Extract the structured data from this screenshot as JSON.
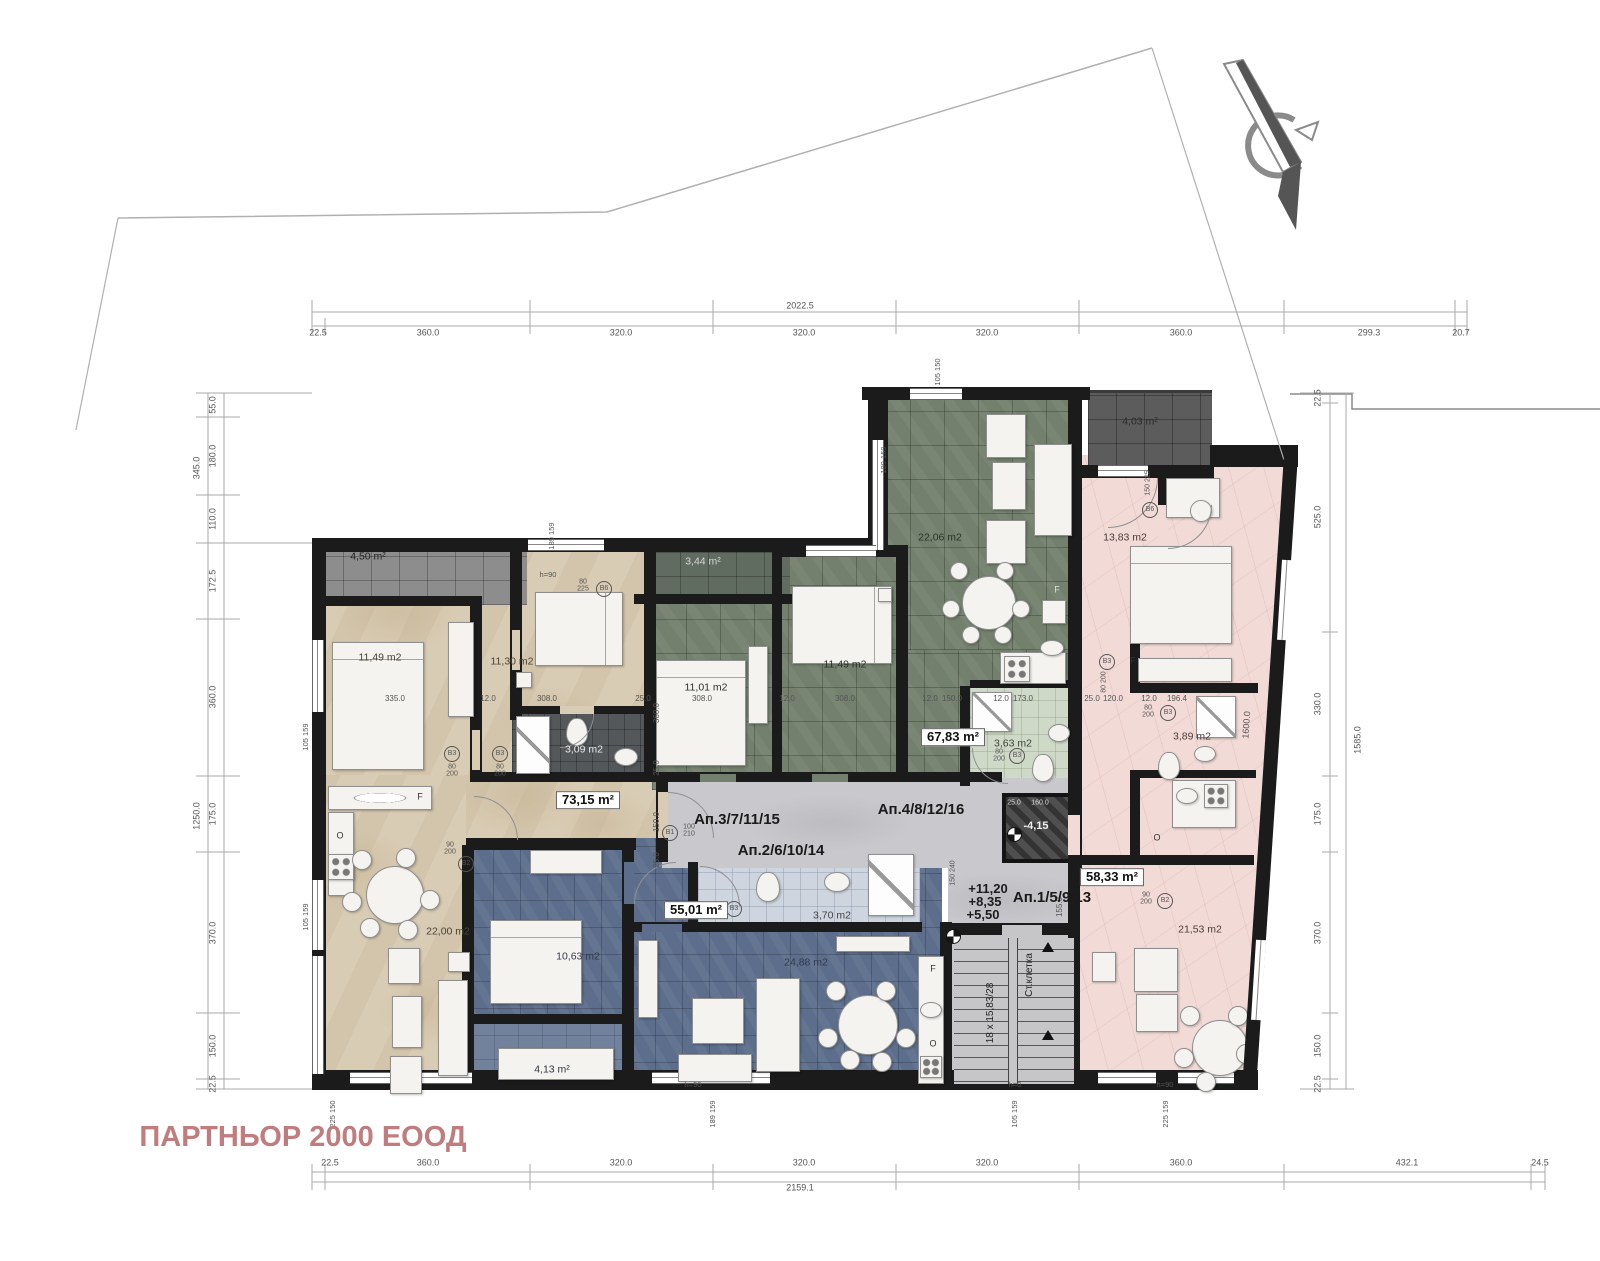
{
  "document": {
    "type": "architectural-floor-plan",
    "company": "ПАРТНЬОР 2000 ЕООД",
    "company_color": "#c17c7e"
  },
  "apartments": [
    {
      "label": "Ап.1/5/9/13",
      "area": "58,33 m²",
      "color": "#f2dbd7",
      "rooms": {
        "bedroom": "13,83 m2",
        "bathroom": "3,89 m2",
        "living_kitchen": "21,53 m2",
        "terrace": "4,03 m²"
      }
    },
    {
      "label": "Ап.2/6/10/14",
      "area": "55,01 m²",
      "color": "#5c6e8c",
      "rooms": {
        "bedroom": "10,63 m2",
        "bathroom": "3,70 m2",
        "living_kitchen": "24,88 m2",
        "terrace": "4,13 m²"
      }
    },
    {
      "label": "Ап.3/7/11/15",
      "area": "73,15 m²",
      "color": "#d9ccb4",
      "rooms": {
        "bedroom_1": "11,49 m2",
        "bedroom_2": "11,30 m2",
        "bathroom": "3,09 m2",
        "living_kitchen": "22,00 m2",
        "terrace": "4,50 m²"
      }
    },
    {
      "label": "Ап.4/8/12/16",
      "area": "67,83 m²",
      "color": "#72806d",
      "rooms": {
        "bedroom_1": "11,01 m2",
        "bedroom_2": "11,49 m2",
        "bathroom": "3,63 m2",
        "living_kitchen": "22,06 m2",
        "terrace": "3,44 m²"
      }
    }
  ],
  "stairwell": {
    "label": "Ст.клетка",
    "steps": "18 x 15,83/28",
    "levels": [
      "+11,20",
      "+8,35",
      "+5,50",
      "+2,65"
    ],
    "shaft_level": "-4,15"
  },
  "site_dimensions": {
    "top_chain": [
      "22.5",
      "360.0",
      "320.0",
      "320.0",
      "320.0",
      "360.0",
      "299.3",
      "20.7"
    ],
    "top_total": "2022.5",
    "bottom_chain": [
      "22.5",
      "360.0",
      "320.0",
      "320.0",
      "320.0",
      "360.0",
      "432.1",
      "24.5"
    ],
    "bottom_total": "2159.1",
    "left_upper_chain": [
      "55.0",
      "180.0",
      "110.0"
    ],
    "left_upper_total": "345.0",
    "left_chain": [
      "172.5",
      "360.0",
      "175.0",
      "370.0",
      "150.0",
      "22.5"
    ],
    "left_total": "1250.0",
    "right_chain": [
      "22.5",
      "525.0",
      "330.0",
      "175.0",
      "370.0",
      "150.0",
      "22.5"
    ],
    "right_total": "1585.0",
    "diagonal": "1600.0"
  },
  "plan": {
    "labels": [
      {
        "t": "22.5",
        "x": 318,
        "y": 333
      },
      {
        "t": "360.0",
        "x": 428,
        "y": 333
      },
      {
        "t": "320.0",
        "x": 621,
        "y": 333
      },
      {
        "t": "320.0",
        "x": 804,
        "y": 333
      },
      {
        "t": "320.0",
        "x": 987,
        "y": 333
      },
      {
        "t": "360.0",
        "x": 1181,
        "y": 333
      },
      {
        "t": "299.3",
        "x": 1369,
        "y": 333
      },
      {
        "t": "20.7",
        "x": 1461,
        "y": 333
      },
      {
        "t": "2022.5",
        "x": 800,
        "y": 306
      },
      {
        "t": "22.5",
        "x": 330,
        "y": 1163
      },
      {
        "t": "360.0",
        "x": 428,
        "y": 1163
      },
      {
        "t": "320.0",
        "x": 621,
        "y": 1163
      },
      {
        "t": "320.0",
        "x": 804,
        "y": 1163
      },
      {
        "t": "320.0",
        "x": 987,
        "y": 1163
      },
      {
        "t": "360.0",
        "x": 1181,
        "y": 1163
      },
      {
        "t": "432.1",
        "x": 1407,
        "y": 1163
      },
      {
        "t": "24.5",
        "x": 1540,
        "y": 1163
      },
      {
        "t": "2159.1",
        "x": 800,
        "y": 1188
      },
      {
        "t": "55.0",
        "x": 213,
        "y": 405,
        "r": -90
      },
      {
        "t": "180.0",
        "x": 213,
        "y": 456,
        "r": -90
      },
      {
        "t": "110.0",
        "x": 213,
        "y": 519,
        "r": -90
      },
      {
        "t": "345.0",
        "x": 197,
        "y": 468,
        "r": -90
      },
      {
        "t": "172.5",
        "x": 213,
        "y": 581,
        "r": -90
      },
      {
        "t": "360.0",
        "x": 213,
        "y": 697,
        "r": -90
      },
      {
        "t": "175.0",
        "x": 213,
        "y": 814,
        "r": -90
      },
      {
        "t": "370.0",
        "x": 213,
        "y": 933,
        "r": -90
      },
      {
        "t": "150.0",
        "x": 213,
        "y": 1046,
        "r": -90
      },
      {
        "t": "22.5",
        "x": 213,
        "y": 1084,
        "r": -90
      },
      {
        "t": "1250.0",
        "x": 197,
        "y": 816,
        "r": -90
      },
      {
        "t": "22.5",
        "x": 1318,
        "y": 398,
        "r": -90
      },
      {
        "t": "525.0",
        "x": 1318,
        "y": 517,
        "r": -90
      },
      {
        "t": "330.0",
        "x": 1318,
        "y": 704,
        "r": -90
      },
      {
        "t": "175.0",
        "x": 1318,
        "y": 814,
        "r": -90
      },
      {
        "t": "370.0",
        "x": 1318,
        "y": 933,
        "r": -90
      },
      {
        "t": "150.0",
        "x": 1318,
        "y": 1046,
        "r": -90
      },
      {
        "t": "22.5",
        "x": 1318,
        "y": 1084,
        "r": -90
      },
      {
        "t": "1585.0",
        "x": 1358,
        "y": 740,
        "r": -90
      },
      {
        "t": "1600.0",
        "x": 1247,
        "y": 725,
        "r": -86
      },
      {
        "t": "335.0",
        "x": 395,
        "y": 699,
        "s": 8
      },
      {
        "t": "12.0",
        "x": 488,
        "y": 699,
        "s": 8
      },
      {
        "t": "308.0",
        "x": 547,
        "y": 699,
        "s": 8
      },
      {
        "t": "25.0",
        "x": 643,
        "y": 699,
        "s": 8
      },
      {
        "t": "308.0",
        "x": 702,
        "y": 699,
        "s": 8
      },
      {
        "t": "12.0",
        "x": 787,
        "y": 699,
        "s": 8
      },
      {
        "t": "308.0",
        "x": 845,
        "y": 699,
        "s": 8
      },
      {
        "t": "12.0",
        "x": 930,
        "y": 699,
        "s": 8
      },
      {
        "t": "150.0",
        "x": 952,
        "y": 699,
        "s": 8
      },
      {
        "t": "12.0",
        "x": 1001,
        "y": 699,
        "s": 8
      },
      {
        "t": "173.0",
        "x": 1023,
        "y": 699,
        "s": 8
      },
      {
        "t": "25.0",
        "x": 1092,
        "y": 699,
        "s": 8
      },
      {
        "t": "120.0",
        "x": 1113,
        "y": 699,
        "s": 8
      },
      {
        "t": "12.0",
        "x": 1149,
        "y": 699,
        "s": 8
      },
      {
        "t": "196.4",
        "x": 1177,
        "y": 699,
        "s": 8
      },
      {
        "t": "360.0",
        "x": 657,
        "y": 713,
        "r": -90,
        "s": 8
      },
      {
        "t": "25.0",
        "x": 657,
        "y": 768,
        "r": -90,
        "s": 8
      },
      {
        "t": "150.0",
        "x": 657,
        "y": 822,
        "r": -90,
        "s": 8
      },
      {
        "t": "25.0",
        "x": 657,
        "y": 860,
        "r": -90,
        "s": 8
      },
      {
        "t": "155.0",
        "x": 1060,
        "y": 907,
        "r": -90,
        "s": 8
      },
      {
        "t": "105  150",
        "x": 938,
        "y": 372,
        "r": -90,
        "s": 7.5
      },
      {
        "t": "189  159",
        "x": 884,
        "y": 460,
        "r": -90,
        "s": 7.5
      },
      {
        "t": "189  159",
        "x": 552,
        "y": 536,
        "r": -90,
        "s": 7.5
      },
      {
        "t": "225  150",
        "x": 333,
        "y": 1114,
        "r": -90,
        "s": 7.5
      },
      {
        "t": "189  159",
        "x": 713,
        "y": 1114,
        "r": -90,
        "s": 7.5
      },
      {
        "t": "105  159",
        "x": 1015,
        "y": 1114,
        "r": -90,
        "s": 7.5
      },
      {
        "t": "225  159",
        "x": 1166,
        "y": 1114,
        "r": -90,
        "s": 7.5
      },
      {
        "t": "105  159",
        "x": 306,
        "y": 737,
        "r": -90,
        "s": 7.5
      },
      {
        "t": "105  159",
        "x": 306,
        "y": 917,
        "r": -90,
        "s": 7.5
      },
      {
        "t": "80\n225",
        "x": 583,
        "y": 586,
        "s": 7
      },
      {
        "t": "B6",
        "x": 604,
        "y": 589,
        "circ": true
      },
      {
        "t": "150  225",
        "x": 1148,
        "y": 483,
        "r": -90,
        "s": 7
      },
      {
        "t": "B6",
        "x": 1150,
        "y": 510,
        "circ": true
      },
      {
        "t": "80\n200",
        "x": 452,
        "y": 771,
        "s": 7
      },
      {
        "t": "B3",
        "x": 452,
        "y": 754,
        "circ": true
      },
      {
        "t": "80\n200",
        "x": 500,
        "y": 771,
        "s": 7
      },
      {
        "t": "B3",
        "x": 500,
        "y": 754,
        "circ": true
      },
      {
        "t": "90\n200",
        "x": 450,
        "y": 849,
        "s": 7
      },
      {
        "t": "B2",
        "x": 466,
        "y": 864,
        "circ": true
      },
      {
        "t": "100\n210",
        "x": 689,
        "y": 831,
        "s": 7
      },
      {
        "t": "B1",
        "x": 670,
        "y": 833,
        "circ": true
      },
      {
        "t": "80\n200",
        "x": 712,
        "y": 910,
        "s": 7
      },
      {
        "t": "B3",
        "x": 734,
        "y": 909,
        "circ": true
      },
      {
        "t": "80\n200",
        "x": 999,
        "y": 756,
        "s": 7
      },
      {
        "t": "B3",
        "x": 1017,
        "y": 756,
        "circ": true
      },
      {
        "t": "80  200",
        "x": 1104,
        "y": 682,
        "r": -90,
        "s": 7
      },
      {
        "t": "B3",
        "x": 1107,
        "y": 662,
        "circ": true
      },
      {
        "t": "80\n200",
        "x": 1148,
        "y": 712,
        "s": 7
      },
      {
        "t": "B3",
        "x": 1168,
        "y": 713,
        "circ": true
      },
      {
        "t": "90\n200",
        "x": 1146,
        "y": 899,
        "s": 7
      },
      {
        "t": "B2",
        "x": 1165,
        "y": 901,
        "circ": true
      },
      {
        "t": "150  240",
        "x": 953,
        "y": 873,
        "r": -90,
        "s": 7
      },
      {
        "t": "+11,20",
        "x": 988,
        "y": 889,
        "s": 13,
        "b": true,
        "c": "#1c1c1c",
        "n": "elevation-level-4"
      },
      {
        "t": "+8,35",
        "x": 985,
        "y": 902,
        "s": 13,
        "b": true,
        "c": "#1c1c1c",
        "n": "elevation-level-3"
      },
      {
        "t": "+5,50",
        "x": 983,
        "y": 915,
        "s": 13,
        "b": true,
        "c": "#1c1c1c",
        "n": "elevation-level-2"
      },
      {
        "t": "+2,65",
        "x": 982,
        "y": 928,
        "s": 13,
        "b": true,
        "c": "#1c1c1c",
        "n": "elevation-level-1"
      },
      {
        "t": "-4,15",
        "x": 1036,
        "y": 827,
        "s": 11,
        "b": true,
        "c": "#f0f0f0",
        "n": "shaft-elevation"
      },
      {
        "t": "25.0",
        "x": 1014,
        "y": 803,
        "s": 7,
        "c": "#ddd"
      },
      {
        "t": "160.0",
        "x": 1040,
        "y": 803,
        "s": 7,
        "c": "#ddd"
      },
      {
        "t": "Ап.3/7/11/15",
        "x": 737,
        "y": 820,
        "s": 15,
        "b": true,
        "c": "#1a1a1a",
        "n": "apartment-label-3"
      },
      {
        "t": "Ап.2/6/10/14",
        "x": 781,
        "y": 851,
        "s": 15,
        "b": true,
        "c": "#1a1a1a",
        "n": "apartment-label-2"
      },
      {
        "t": "Ап.4/8/12/16",
        "x": 921,
        "y": 810,
        "s": 15,
        "b": true,
        "c": "#1a1a1a",
        "n": "apartment-label-4"
      },
      {
        "t": "Ап.1/5/9/13",
        "x": 1052,
        "y": 898,
        "s": 15,
        "b": true,
        "c": "#1a1a1a",
        "n": "apartment-label-1"
      },
      {
        "t": "73,15 m²",
        "x": 588,
        "y": 800,
        "s": 13,
        "b": true,
        "chip": true,
        "n": "area-chip-apt3"
      },
      {
        "t": "55,01 m²",
        "x": 696,
        "y": 910,
        "s": 13,
        "b": true,
        "chip": true,
        "n": "area-chip-apt2"
      },
      {
        "t": "67,83 m²",
        "x": 953,
        "y": 737,
        "s": 13,
        "b": true,
        "chip": true,
        "n": "area-chip-apt4"
      },
      {
        "t": "58,33 m²",
        "x": 1112,
        "y": 877,
        "s": 13,
        "b": true,
        "chip": true,
        "n": "area-chip-apt1"
      },
      {
        "t": "4,50 m²",
        "x": 368,
        "y": 557,
        "s": 10.5,
        "c": "#222",
        "n": "room-area"
      },
      {
        "t": "11,49 m2",
        "x": 380,
        "y": 658,
        "s": 10.5,
        "c": "#4a4336",
        "n": "room-area"
      },
      {
        "t": "11,30 m2",
        "x": 512,
        "y": 662,
        "s": 10.5,
        "c": "#4a4336",
        "n": "room-area"
      },
      {
        "t": "3,09 m2",
        "x": 584,
        "y": 750,
        "s": 10.5,
        "c": "#e8e8e8",
        "n": "room-area"
      },
      {
        "t": "22,00 m2",
        "x": 448,
        "y": 932,
        "s": 10.5,
        "c": "#4a4336",
        "n": "room-area"
      },
      {
        "t": "3,44 m²",
        "x": 703,
        "y": 562,
        "s": 10.5,
        "c": "#d6d6d6",
        "n": "room-area"
      },
      {
        "t": "11,01 m2",
        "x": 706,
        "y": 688,
        "s": 10.5,
        "c": "#2c332a",
        "n": "room-area"
      },
      {
        "t": "11,49 m2",
        "x": 845,
        "y": 665,
        "s": 10.5,
        "c": "#2c332a",
        "n": "room-area"
      },
      {
        "t": "22,06 m2",
        "x": 940,
        "y": 538,
        "s": 10.5,
        "c": "#2c332a",
        "n": "room-area"
      },
      {
        "t": "3,63 m2",
        "x": 1013,
        "y": 744,
        "s": 10.5,
        "c": "#3c4438",
        "n": "room-area"
      },
      {
        "t": "4,03 m²",
        "x": 1140,
        "y": 422,
        "s": 10.5,
        "c": "#2b2b2b",
        "n": "room-area"
      },
      {
        "t": "13,83 m2",
        "x": 1125,
        "y": 538,
        "s": 10.5,
        "c": "#4c3c3a",
        "n": "room-area"
      },
      {
        "t": "3,89 m2",
        "x": 1192,
        "y": 737,
        "s": 10.5,
        "c": "#4c3c3a",
        "n": "room-area"
      },
      {
        "t": "10,63 m2",
        "x": 578,
        "y": 957,
        "s": 10.5,
        "c": "#323a49",
        "n": "room-area"
      },
      {
        "t": "24,88 m2",
        "x": 806,
        "y": 963,
        "s": 10.5,
        "c": "#323a49",
        "n": "room-area"
      },
      {
        "t": "4,13 m²",
        "x": 552,
        "y": 1070,
        "s": 10.5,
        "c": "#2e3542",
        "n": "room-area"
      },
      {
        "t": "21,53 m2",
        "x": 1200,
        "y": 930,
        "s": 10.5,
        "c": "#4c3c3a",
        "n": "room-area"
      },
      {
        "t": "3,70 m2",
        "x": 832,
        "y": 916,
        "s": 10.5,
        "c": "#444",
        "n": "room-area"
      },
      {
        "t": "F",
        "x": 420,
        "y": 797,
        "s": 9,
        "c": "#333",
        "n": "fridge-letter"
      },
      {
        "t": "O",
        "x": 340,
        "y": 836,
        "s": 9,
        "c": "#333",
        "n": "oven-letter"
      },
      {
        "t": "F",
        "x": 1057,
        "y": 590,
        "s": 9,
        "c": "#ddd",
        "n": "fridge-letter"
      },
      {
        "t": "F",
        "x": 933,
        "y": 969,
        "s": 9,
        "c": "#333",
        "n": "fridge-letter"
      },
      {
        "t": "O",
        "x": 933,
        "y": 1044,
        "s": 9,
        "c": "#333",
        "n": "oven-letter"
      },
      {
        "t": "O",
        "x": 1157,
        "y": 838,
        "s": 9,
        "c": "#333",
        "n": "oven-letter"
      },
      {
        "t": "F",
        "x": 1133,
        "y": 661,
        "s": 9,
        "c": "#333",
        "n": "fridge-letter"
      },
      {
        "t": "h=90",
        "x": 548,
        "y": 575,
        "s": 7.5
      },
      {
        "t": "h=90",
        "x": 693,
        "y": 1085,
        "s": 7.5
      },
      {
        "t": "h=0",
        "x": 1015,
        "y": 1085,
        "s": 7.5
      },
      {
        "t": "h=90",
        "x": 1165,
        "y": 1085,
        "s": 7.5
      },
      {
        "t": "Ст.клетка",
        "x": 1030,
        "y": 975,
        "r": -90,
        "s": 10,
        "c": "#222",
        "n": "stairwell-label"
      },
      {
        "t": "18 x 15,83/28",
        "x": 991,
        "y": 1013,
        "r": -90,
        "s": 10,
        "c": "#222",
        "n": "stair-steps-label"
      },
      {
        "t": "ПАРТНЬОР 2000 ЕООД",
        "x": 303,
        "y": 1137,
        "s": 29,
        "b": true,
        "c": "#c17c7e",
        "n": "company-name"
      }
    ]
  }
}
